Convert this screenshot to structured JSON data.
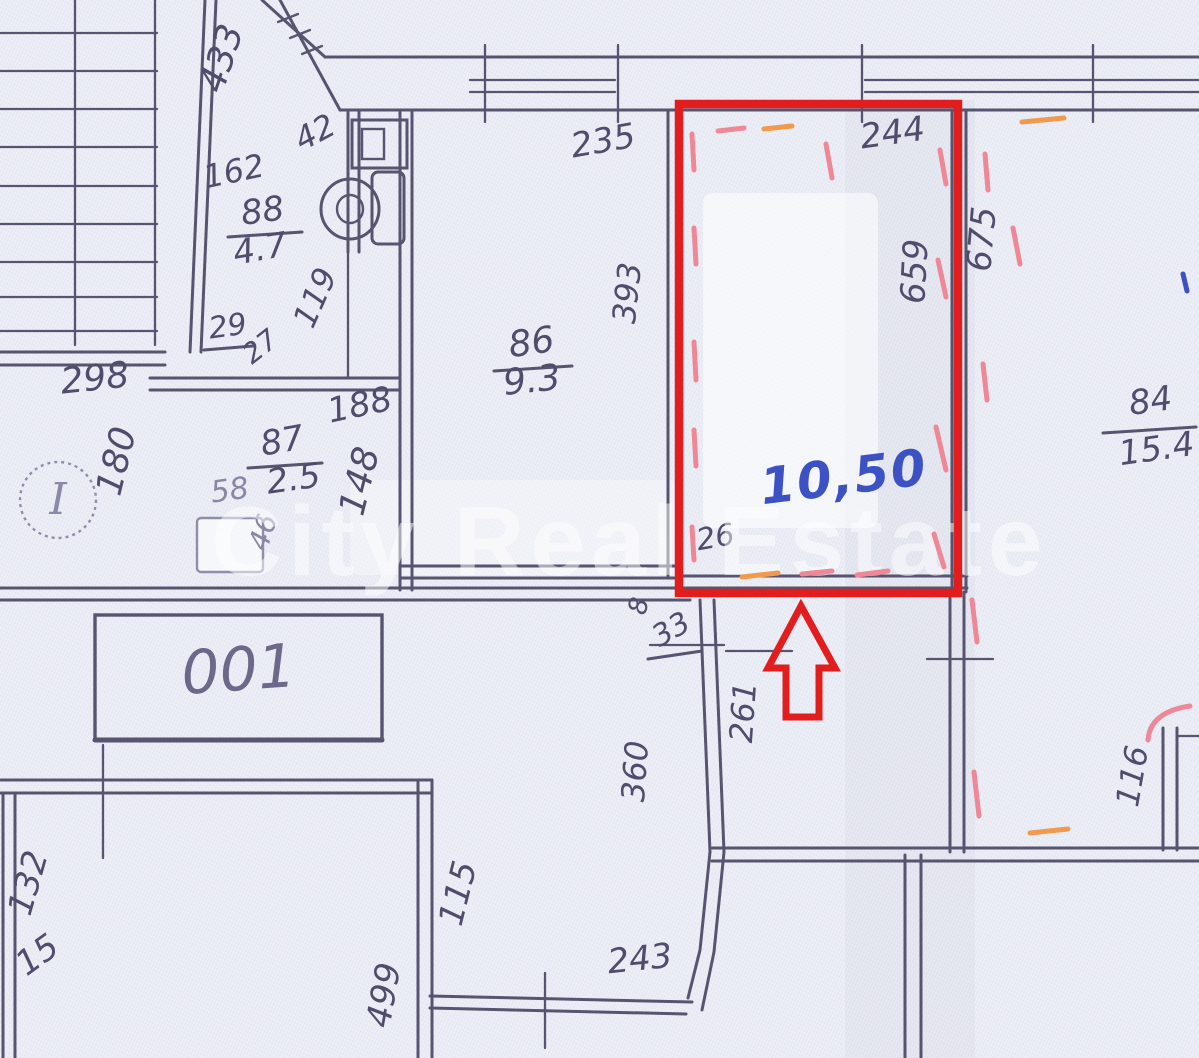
{
  "plan": {
    "type": "scanned-floor-plan",
    "watermark": "City Real Estate",
    "highlighted_room": {
      "area_value": "10,50",
      "width_cm": "244",
      "depth_cm": "659",
      "highlight_color": "#e11d1d",
      "dash_color": "#ef8896",
      "area_text_color": "#3b51c4",
      "arrow_direction": "up"
    },
    "rooms": [
      {
        "number": "88",
        "area": "4.7"
      },
      {
        "number": "86",
        "area": "9.3"
      },
      {
        "number": "87",
        "area": "2.5"
      },
      {
        "number": "84",
        "area": "15.4"
      }
    ],
    "door_label": "001",
    "stair_marker": "I",
    "labels": {
      "dim-433": "433",
      "dim-42": "42",
      "dim-162": "162",
      "room-88-number": "88",
      "room-88-area": "4.7",
      "dim-119": "119",
      "dim-29": "29",
      "dim-27": "27",
      "dim-298": "298",
      "dim-180": "180",
      "dim-188": "188",
      "room-87-number": "87",
      "room-87-area": "2.5",
      "dim-58": "58",
      "dim-46": "46",
      "dim-148": "148",
      "dim-235": "235",
      "room-86-number": "86",
      "room-86-area": "9.3",
      "dim-393": "393",
      "dim-244": "244",
      "dim-659": "659",
      "dim-675": "675",
      "room-84-number": "84",
      "room-84-area": "15.4",
      "area-1050": "10,50",
      "dim-26": "26",
      "dim-8": "8",
      "dim-33": "33",
      "dim-261": "261",
      "dim-360": "360",
      "door-001": "001",
      "dim-132": "132",
      "dim-15": "15",
      "dim-115": "115",
      "dim-499": "499",
      "dim-243": "243",
      "dim-116": "116",
      "stair-marker": "I",
      "watermark": "City Real Estate"
    }
  }
}
